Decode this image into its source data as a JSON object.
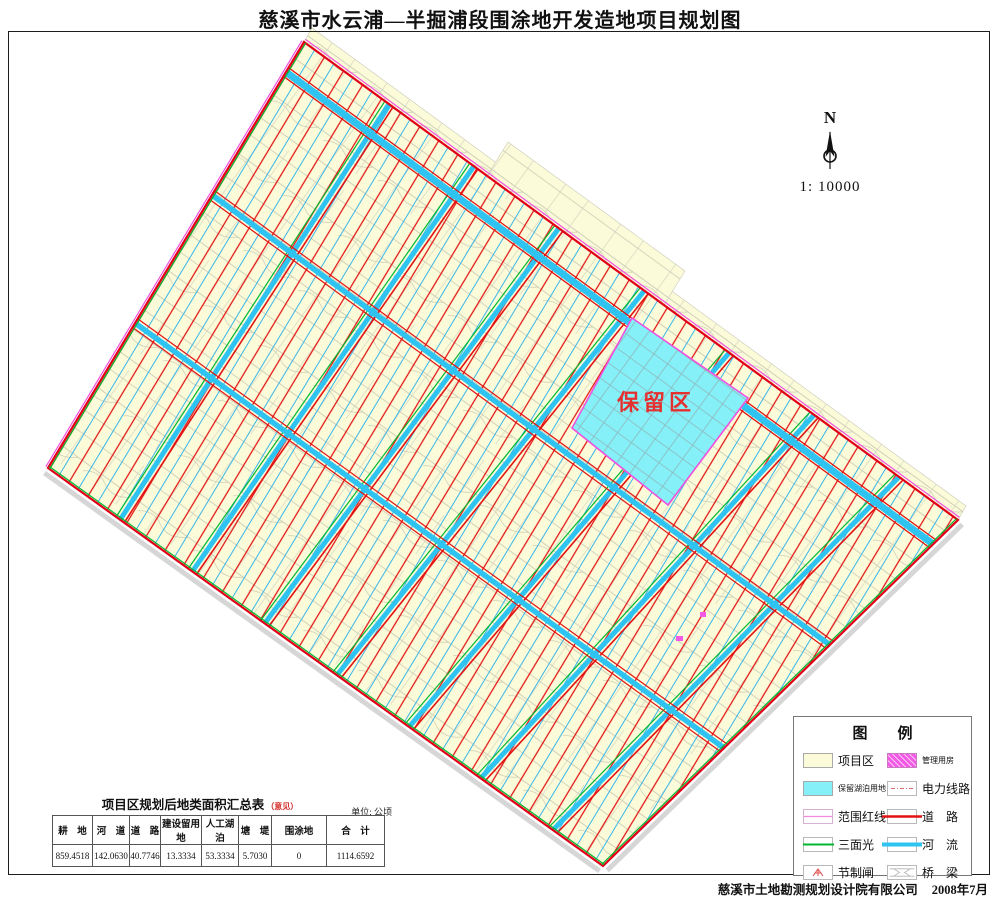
{
  "page": {
    "title": "慈溪市水云浦—半掘浦段围涂地开发造地项目规划图",
    "credit": "慈溪市土地勘测规划设计院有限公司",
    "date": "2008年7月"
  },
  "compass": {
    "north_label": "N",
    "scale_label": "1: 10000"
  },
  "map": {
    "reserved_area_label": "保留区"
  },
  "legend": {
    "title": "图　　例",
    "items": [
      {
        "label": "项目区",
        "swatch": "project-area"
      },
      {
        "label": "管理用房",
        "swatch": "management-housing"
      },
      {
        "label": "保留湖泊用地",
        "swatch": "reserved-lake-land"
      },
      {
        "label": "电力线路",
        "swatch": "power-line"
      },
      {
        "label": "范围红线",
        "swatch": "boundary-red-line"
      },
      {
        "label": "道　路",
        "swatch": "road"
      },
      {
        "label": "三面光",
        "swatch": "lined-channel"
      },
      {
        "label": "河　流",
        "swatch": "river"
      },
      {
        "label": "节制闸",
        "swatch": "control-gate"
      },
      {
        "label": "桥　梁",
        "swatch": "bridge"
      }
    ]
  },
  "area_table": {
    "title": "项目区规划后地类面积汇总表",
    "title_note": "（意见）",
    "unit": "单位: 公顷",
    "columns": [
      "耕　地",
      "河　道",
      "道　路",
      "建设留用地",
      "人工湖泊",
      "塘　堤",
      "围涂地",
      "合　计"
    ],
    "values": [
      "859.4518",
      "142.0630",
      "40.7746",
      "13.3334",
      "53.3334",
      "5.7030",
      "0",
      "1114.6592"
    ]
  },
  "colors": {
    "land_fill": "#FBFBD9",
    "road_red": "#E21212",
    "stripe_cyan": "#3AB6E8",
    "main_river_cyan": "#2EC3F0",
    "channel_green": "#00B830",
    "boundary_magenta": "#F050E0",
    "reserved_fill": "#85F0F8",
    "reserved_label_red": "#E53030",
    "management_magenta": "#F25AE6"
  }
}
